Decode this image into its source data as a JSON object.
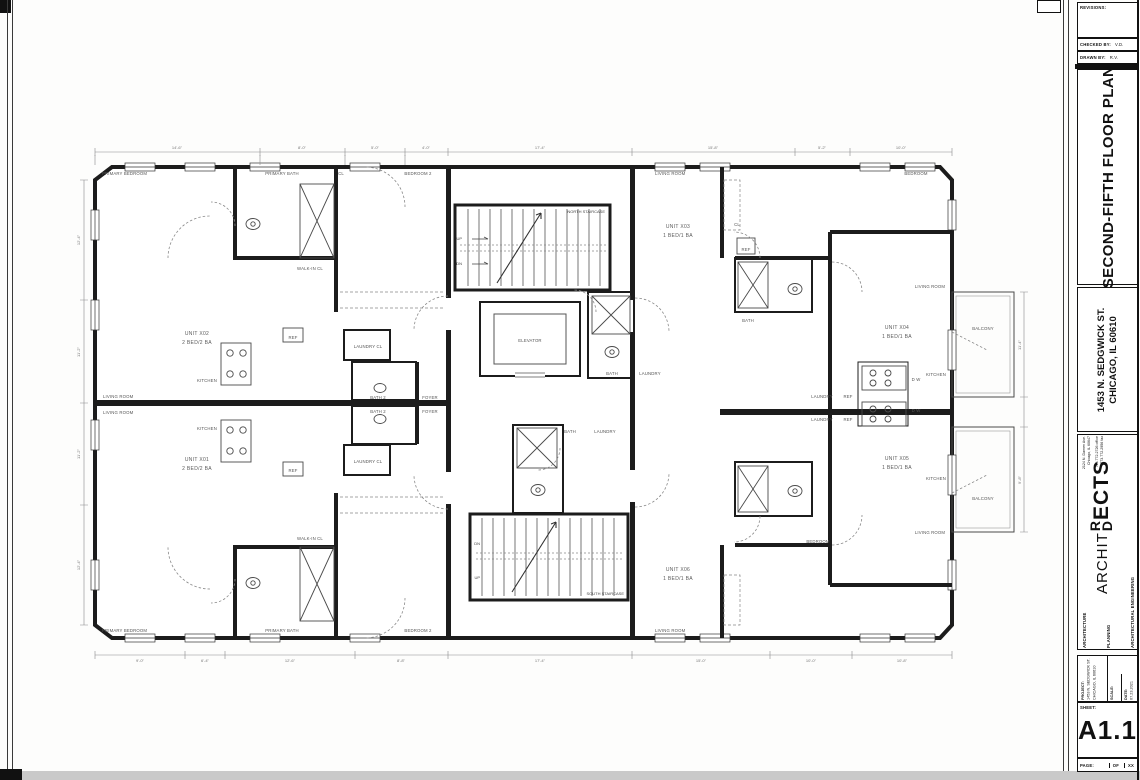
{
  "sheet": {
    "revisions_label": "REVISIONS:",
    "checked_by_label": "CHECKED BY:",
    "checked_by_value": "V.D.",
    "drawn_by_label": "DRAWN BY:",
    "drawn_by_value": "R.V.",
    "sheet_title": "SECOND-FIFTH FLOOR PLAN",
    "address_line1": "1453 N. SEDGWICK ST.",
    "address_line2": "CHICAGO, IL 60610",
    "firm": {
      "service1": "ARCHITECTURE",
      "service2": "PLANNING",
      "service3": "ARCHITECTURAL ENGINEERING",
      "name_part1": "ARCHIT",
      "name_part2": "ECTS",
      "monogram_top": "R",
      "monogram_bottom": "D",
      "addr1": "2124 N. Damen Ave.",
      "addr2": "Chicago, IL 60647",
      "phone1": "773.772.2726 office",
      "phone2": "773.772.2956 fax"
    },
    "project_label": "PROJECT:",
    "project_line1": "1453 N. SEDGWICK ST.",
    "project_line2": "CHICAGO, IL 60610",
    "scale_label": "SCALE:",
    "date_label": "DATE:",
    "date_value": "07.23.2021",
    "sheet_label": "SHEET:",
    "sheet_number": "A1.1",
    "page_label": "PAGE:",
    "page_of": "OF",
    "page_total": "XX"
  },
  "plan": {
    "units": [
      {
        "name": "UNIT X02",
        "type": "2 BED/2 BA"
      },
      {
        "name": "UNIT X01",
        "type": "2 BED/2 BA"
      },
      {
        "name": "UNIT X03",
        "type": "1 BED/1 BA"
      },
      {
        "name": "UNIT X04",
        "type": "1 BED/1 BA"
      },
      {
        "name": "UNIT X05",
        "type": "1 BED/1 BA"
      },
      {
        "name": "UNIT X06",
        "type": "1 BED/1 BA"
      }
    ],
    "rooms": {
      "primary_bedroom": "PRIMARY BEDROOM",
      "primary_bath": "PRIMARY BATH",
      "bedroom_2": "BEDROOM 2",
      "bedroom": "BEDROOM",
      "living_room": "LIVING ROOM",
      "kitchen": "KITCHEN",
      "bath": "BATH",
      "bath_2": "BATH 2",
      "foyer": "FOYER",
      "laundry": "LAUNDRY",
      "laundry_cl": "LAUNDRY  CL",
      "walk_in_cl": "WALK-IN CL",
      "balcony": "BALCONY",
      "elevator": "ELEVATOR",
      "north_staircase": "NORTH STAIRCASE",
      "south_staircase": "SOUTH STAIRCASE",
      "cl": "CL",
      "ref": "REF",
      "dw": "D W",
      "up": "UP",
      "dn": "DN"
    },
    "dims": {
      "top": [
        "14'-6\"",
        "8'-0\"",
        "5'-0\"",
        "4'-0\"",
        "17'-4\"",
        "15'-8\"",
        "5'-2\"",
        "10'-0\""
      ],
      "bottom": [
        "9'-0\"",
        "6'-4\"",
        "12'-6\"",
        "8'-8\"",
        "17'-4\"",
        "15'-0\"",
        "10'-0\"",
        "10'-8\""
      ],
      "left": [
        "12'-4\"",
        "11'-2\"",
        "11'-2\"",
        "12'-4\""
      ],
      "right": [
        "11'-4\"",
        "9'-8\""
      ]
    }
  },
  "colors": {
    "wall": "#1c1c1c",
    "thin_line": "#4a4a4a",
    "label": "#555555",
    "dim": "#777777",
    "page_edge": "#c9c9c9"
  }
}
